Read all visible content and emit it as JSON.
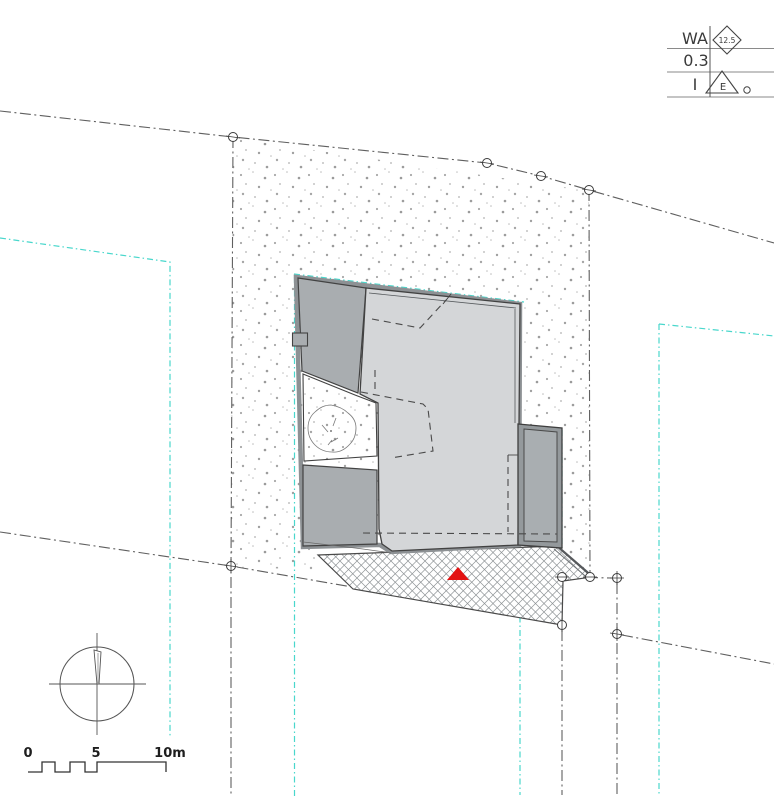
{
  "drawing": {
    "title_block": {
      "row1_code": "WA",
      "diamond_value": "12.5",
      "row2_code": "0.3",
      "row3_code": "I",
      "triangle_label": "E"
    },
    "scale_bar": {
      "label_start": "0",
      "label_mid": "5",
      "label_end": "10m"
    },
    "colors": {
      "accent_cyan": "#49d7cc",
      "marker_red": "#e31212",
      "building_light": "#d4d6d8",
      "building_mid": "#a9adb0",
      "annex_frame": "#94999c",
      "annex_inner": "#a9aeb1",
      "boundary_gray": "#5f5f5f",
      "hatch_gray": "#8e9396",
      "wall_dark": "#424242"
    }
  }
}
